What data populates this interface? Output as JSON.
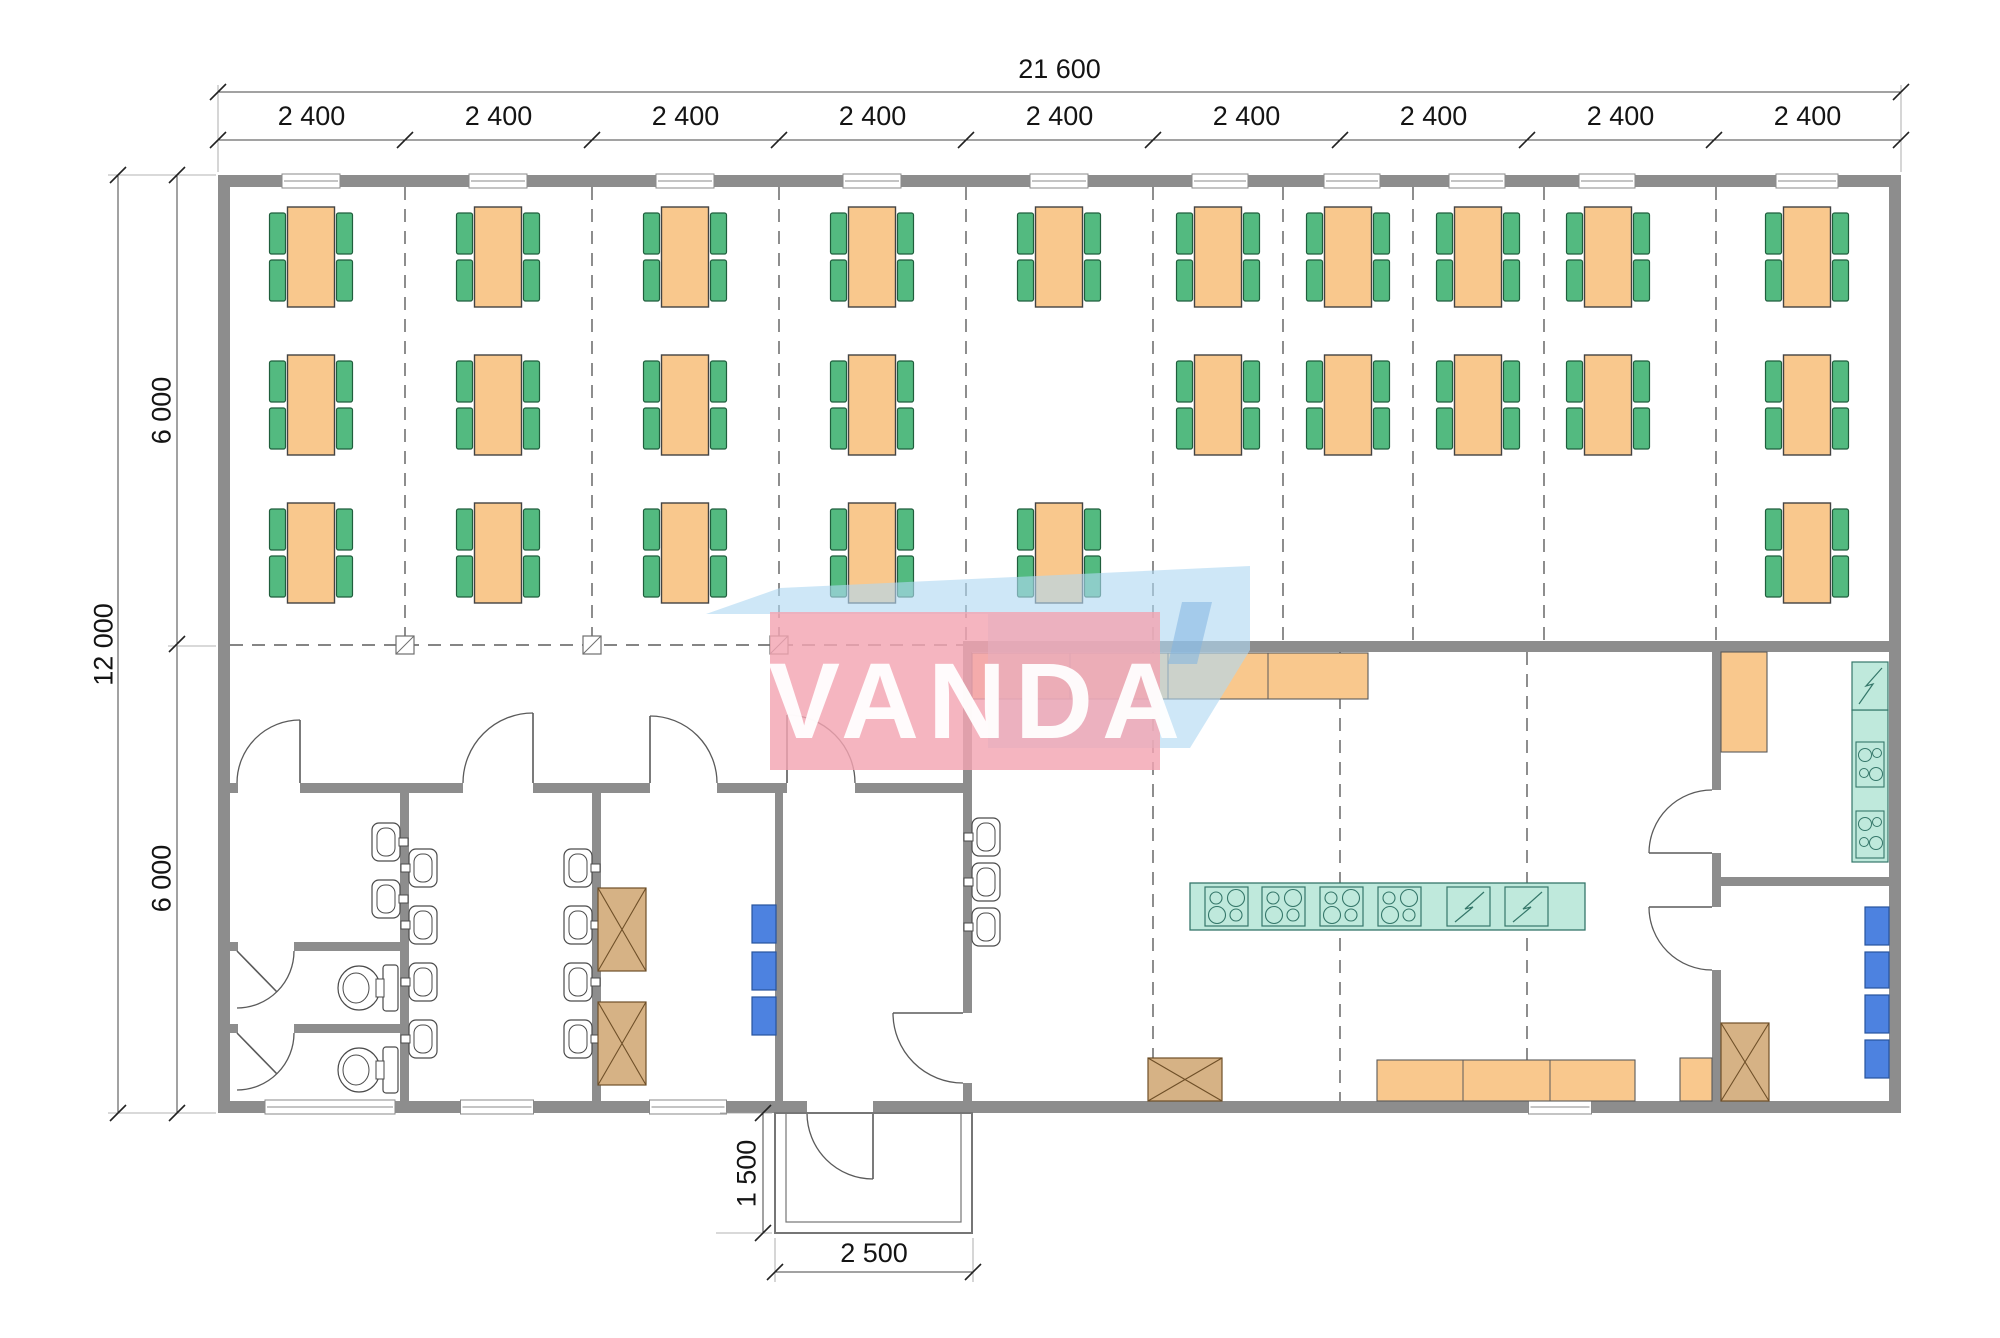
{
  "watermark": {
    "text": "VANDA",
    "pink_box": [
      770,
      612,
      390,
      158
    ],
    "pink_color": "rgba(243,165,178,0.82)",
    "blue_points": "706,614 780,588 1250,566 1250,650 1190,748 988,748 988,614",
    "blue_color": "rgba(176,216,242,0.62)",
    "accent_points": "1182,602 1212,602 1197,664 1168,664",
    "accent_color": "rgba(130,180,225,0.55)"
  },
  "dimensions": {
    "total_width": "21 600",
    "bays": [
      "2 400",
      "2 400",
      "2 400",
      "2 400",
      "2 400",
      "2 400",
      "2 400",
      "2 400",
      "2 400"
    ],
    "total_height": "12 000",
    "half_heights": [
      "6 000",
      "6 000"
    ],
    "porch_depth": "1 500",
    "porch_width": "2 500"
  },
  "colors": {
    "wall": "#8d8d8d",
    "line": "#4a4a4a",
    "dash": "#5d5d5d",
    "dimline": "#444444",
    "table": "#f9c88d",
    "tableStroke": "#434343",
    "chair": "#53ba80",
    "chairStroke": "#1f5e3c",
    "teal": "#bfe9dc",
    "tealStroke": "#35776a",
    "blueBox": "#4d82e0",
    "blueBoxStroke": "#27549e",
    "brown": "#d6b285",
    "brownStroke": "#6e4f28",
    "fixture": "#ffffff",
    "fixtureStroke": "#4a4a4a",
    "windowStroke": "#8a8a8a"
  },
  "plan": {
    "walls": [
      [
        218,
        175,
        1683,
        12
      ],
      [
        218,
        1101,
        589,
        12
      ],
      [
        873,
        1101,
        1028,
        12
      ],
      [
        218,
        175,
        12,
        938
      ],
      [
        1889,
        175,
        12,
        938
      ],
      [
        963,
        641,
        938,
        11
      ],
      [
        963,
        652,
        9,
        361
      ],
      [
        963,
        1083,
        9,
        18
      ],
      [
        230,
        783,
        8,
        10
      ],
      [
        300,
        783,
        163,
        10
      ],
      [
        533,
        783,
        117,
        10
      ],
      [
        717,
        783,
        70,
        10
      ],
      [
        855,
        783,
        108,
        10
      ],
      [
        400,
        793,
        9,
        308
      ],
      [
        592,
        783,
        9,
        318
      ],
      [
        775,
        783,
        8,
        318
      ],
      [
        230,
        942,
        8,
        9
      ],
      [
        294,
        942,
        106,
        9
      ],
      [
        230,
        1024,
        8,
        9
      ],
      [
        294,
        1024,
        106,
        9
      ],
      [
        1712,
        652,
        9,
        138
      ],
      [
        1712,
        853,
        9,
        54
      ],
      [
        1712,
        970,
        9,
        131
      ],
      [
        1721,
        877,
        168,
        9
      ]
    ],
    "windows_top": {
      "y": 174,
      "h": 14,
      "items": [
        [
          311,
          58
        ],
        [
          498,
          58
        ],
        [
          685,
          58
        ],
        [
          872,
          58
        ],
        [
          1059,
          58
        ],
        [
          1220,
          56
        ],
        [
          1352,
          56
        ],
        [
          1477,
          56
        ],
        [
          1607,
          56
        ],
        [
          1807,
          62
        ]
      ]
    },
    "windows_bottom": {
      "y": 1100,
      "h": 14,
      "items": [
        [
          330,
          130
        ],
        [
          497,
          73
        ],
        [
          688,
          77
        ],
        [
          1560,
          63
        ]
      ]
    },
    "grid": [
      [
        405,
        187,
        405,
        641
      ],
      [
        592,
        187,
        592,
        641
      ],
      [
        779,
        187,
        779,
        641
      ],
      [
        966,
        187,
        966,
        641
      ],
      [
        1153,
        187,
        1153,
        641
      ],
      [
        1283,
        187,
        1283,
        641
      ],
      [
        1413,
        187,
        1413,
        641
      ],
      [
        1544,
        187,
        1544,
        641
      ],
      [
        1716,
        187,
        1716,
        641
      ],
      [
        1153,
        652,
        1153,
        1101
      ],
      [
        1340,
        652,
        1340,
        1101
      ],
      [
        1527,
        652,
        1527,
        1101
      ],
      [
        230,
        645,
        963,
        645
      ]
    ],
    "markers": {
      "y": 645,
      "size": 18,
      "xs": [
        405,
        592,
        779
      ]
    },
    "tables": {
      "row_y": [
        207,
        355,
        503
      ],
      "w": 47,
      "h": 100,
      "chair_w": 16,
      "chair_h": 41,
      "units": [
        [
          311,
          0
        ],
        [
          498,
          0
        ],
        [
          685,
          0
        ],
        [
          872,
          0
        ],
        [
          1059,
          0
        ],
        [
          1218,
          0
        ],
        [
          1348,
          0
        ],
        [
          1478,
          0
        ],
        [
          1608,
          0
        ],
        [
          1807,
          0
        ],
        [
          311,
          1
        ],
        [
          498,
          1
        ],
        [
          685,
          1
        ],
        [
          872,
          1
        ],
        [
          1218,
          1
        ],
        [
          1348,
          1
        ],
        [
          1478,
          1
        ],
        [
          1608,
          1
        ],
        [
          1807,
          1
        ],
        [
          311,
          2
        ],
        [
          498,
          2
        ],
        [
          685,
          2
        ],
        [
          872,
          2
        ],
        [
          1059,
          2
        ],
        [
          1807,
          2
        ]
      ]
    },
    "sinks": {
      "w": 28,
      "h": 38,
      "items": [
        {
          "x": 372,
          "cy": 842,
          "f": "r"
        },
        {
          "x": 372,
          "cy": 899,
          "f": "r"
        },
        {
          "x": 564,
          "cy": 868,
          "f": "r"
        },
        {
          "x": 564,
          "cy": 925,
          "f": "r"
        },
        {
          "x": 564,
          "cy": 982,
          "f": "r"
        },
        {
          "x": 564,
          "cy": 1039,
          "f": "r"
        },
        {
          "x": 409,
          "cy": 868,
          "f": "l"
        },
        {
          "x": 409,
          "cy": 925,
          "f": "l"
        },
        {
          "x": 409,
          "cy": 982,
          "f": "l"
        },
        {
          "x": 409,
          "cy": 1039,
          "f": "l"
        },
        {
          "x": 972,
          "cy": 837,
          "f": "l"
        },
        {
          "x": 972,
          "cy": 882,
          "f": "l"
        },
        {
          "x": 972,
          "cy": 927,
          "f": "l"
        }
      ]
    },
    "toilets": [
      {
        "cy": 988
      },
      {
        "cy": 1070
      }
    ],
    "doors": [
      {
        "arc": "M237 783A63 63 0 0 1 300 720",
        "leaf": "M300 783L300 720"
      },
      {
        "arc": "M463 783A70 70 0 0 1 533 713",
        "leaf": "M533 783L533 713"
      },
      {
        "arc": "M717 783A67 67 0 0 0 650 716",
        "leaf": "M650 783L650 716"
      },
      {
        "arc": "M855 783A68 68 0 0 0 787 715",
        "leaf": "M787 783L787 715"
      },
      {
        "arc": "M963 1083A70 70 0 0 1 893 1013",
        "leaf": "M963 1013L893 1013"
      },
      {
        "arc": "M807 1113A66 66 0 0 0 873 1179",
        "leaf": "M873 1113L873 1179"
      },
      {
        "arc": "M1712 790A63 63 0 0 0 1649 853",
        "leaf": "M1712 853L1649 853"
      },
      {
        "arc": "M1712 970A63 63 0 0 1 1649 907",
        "leaf": "M1712 907L1649 907"
      },
      {
        "arc": "M294 951A57 57 0 0 1 237 1008",
        "leaf": "M237 951L277 992"
      },
      {
        "arc": "M294 1033A57 57 0 0 1 237 1090",
        "leaf": "M237 1033L277 1074"
      }
    ],
    "counters": [
      {
        "r": [
          972,
          653,
          396,
          46
        ],
        "div": [
          1070,
          1168,
          1268
        ]
      },
      {
        "r": [
          1377,
          1060,
          258,
          41
        ],
        "div": [
          1463,
          1550
        ]
      },
      {
        "r": [
          1680,
          1058,
          32,
          43
        ],
        "div": []
      },
      {
        "r": [
          1721,
          652,
          46,
          100
        ],
        "div": []
      }
    ],
    "island": {
      "r": [
        1190,
        883,
        395,
        47
      ],
      "burners": {
        "y": 887,
        "w": 43,
        "h": 39,
        "xs": [
          1205,
          1262,
          1320,
          1378
        ],
        "circles": [
          [
            11,
            11,
            6
          ],
          [
            31,
            11,
            8.5
          ],
          [
            12,
            28,
            8.5
          ],
          [
            31,
            28,
            6
          ]
        ]
      },
      "flash": {
        "y": 887,
        "w": 43,
        "h": 39,
        "xs": [
          1447,
          1505
        ],
        "pts": [
          37,
          5,
          18,
          22,
          26,
          20,
          8,
          35
        ]
      }
    },
    "teal_right": {
      "fridge": [
        1852,
        662,
        36,
        48
      ],
      "fridge_pts": [
        30,
        6,
        14,
        24,
        21,
        22,
        7,
        42
      ],
      "strip": [
        1852,
        710,
        36,
        152
      ],
      "burners": [
        [
          1856,
          742,
          28,
          45
        ],
        [
          1856,
          811,
          28,
          47
        ]
      ],
      "burner_circles": [
        [
          9,
          13,
          6.5
        ],
        [
          21,
          11,
          4.5
        ],
        [
          8,
          31,
          4.5
        ],
        [
          20,
          32,
          6.5
        ]
      ]
    },
    "crossed_boxes": [
      [
        598,
        888,
        48,
        83
      ],
      [
        598,
        1002,
        48,
        83
      ],
      [
        1148,
        1058,
        74,
        43
      ],
      [
        1721,
        1023,
        48,
        78
      ]
    ],
    "blue_boxes": [
      [
        752,
        905,
        24,
        38
      ],
      [
        752,
        952,
        24,
        38
      ],
      [
        752,
        997,
        24,
        38
      ],
      [
        1865,
        907,
        24,
        38
      ],
      [
        1865,
        952,
        24,
        36
      ],
      [
        1865,
        995,
        24,
        38
      ],
      [
        1865,
        1040,
        24,
        38
      ]
    ],
    "porch": [
      [
        775,
        1113,
        197,
        120
      ],
      [
        786,
        1113,
        175,
        109
      ]
    ],
    "dim_lines": [
      [
        218,
        92,
        1901,
        92
      ],
      [
        218,
        140,
        1901,
        140
      ],
      [
        118,
        175,
        118,
        1113
      ],
      [
        177,
        175,
        177,
        1113
      ],
      [
        763,
        1113,
        763,
        1233
      ],
      [
        775,
        1272,
        973,
        1272
      ]
    ],
    "ext_lines": [
      [
        218,
        85,
        218,
        172
      ],
      [
        1901,
        85,
        1901,
        172
      ],
      [
        108,
        175,
        216,
        175
      ],
      [
        108,
        1113,
        216,
        1113
      ],
      [
        168,
        646,
        216,
        646
      ],
      [
        775,
        1238,
        775,
        1282
      ],
      [
        973,
        1238,
        973,
        1282
      ],
      [
        720,
        1113,
        772,
        1113
      ],
      [
        716,
        1233,
        772,
        1233
      ]
    ],
    "ticks": [
      [
        218,
        92
      ],
      [
        1901,
        92
      ],
      [
        218,
        140
      ],
      [
        405,
        140
      ],
      [
        592,
        140
      ],
      [
        779,
        140
      ],
      [
        966,
        140
      ],
      [
        1153,
        140
      ],
      [
        1340,
        140
      ],
      [
        1527,
        140
      ],
      [
        1714,
        140
      ],
      [
        1901,
        140
      ],
      [
        118,
        175
      ],
      [
        118,
        1113
      ],
      [
        177,
        175
      ],
      [
        177,
        644
      ],
      [
        177,
        1113
      ],
      [
        763,
        1113
      ],
      [
        763,
        1233
      ],
      [
        775,
        1272
      ],
      [
        973,
        1272
      ]
    ]
  }
}
